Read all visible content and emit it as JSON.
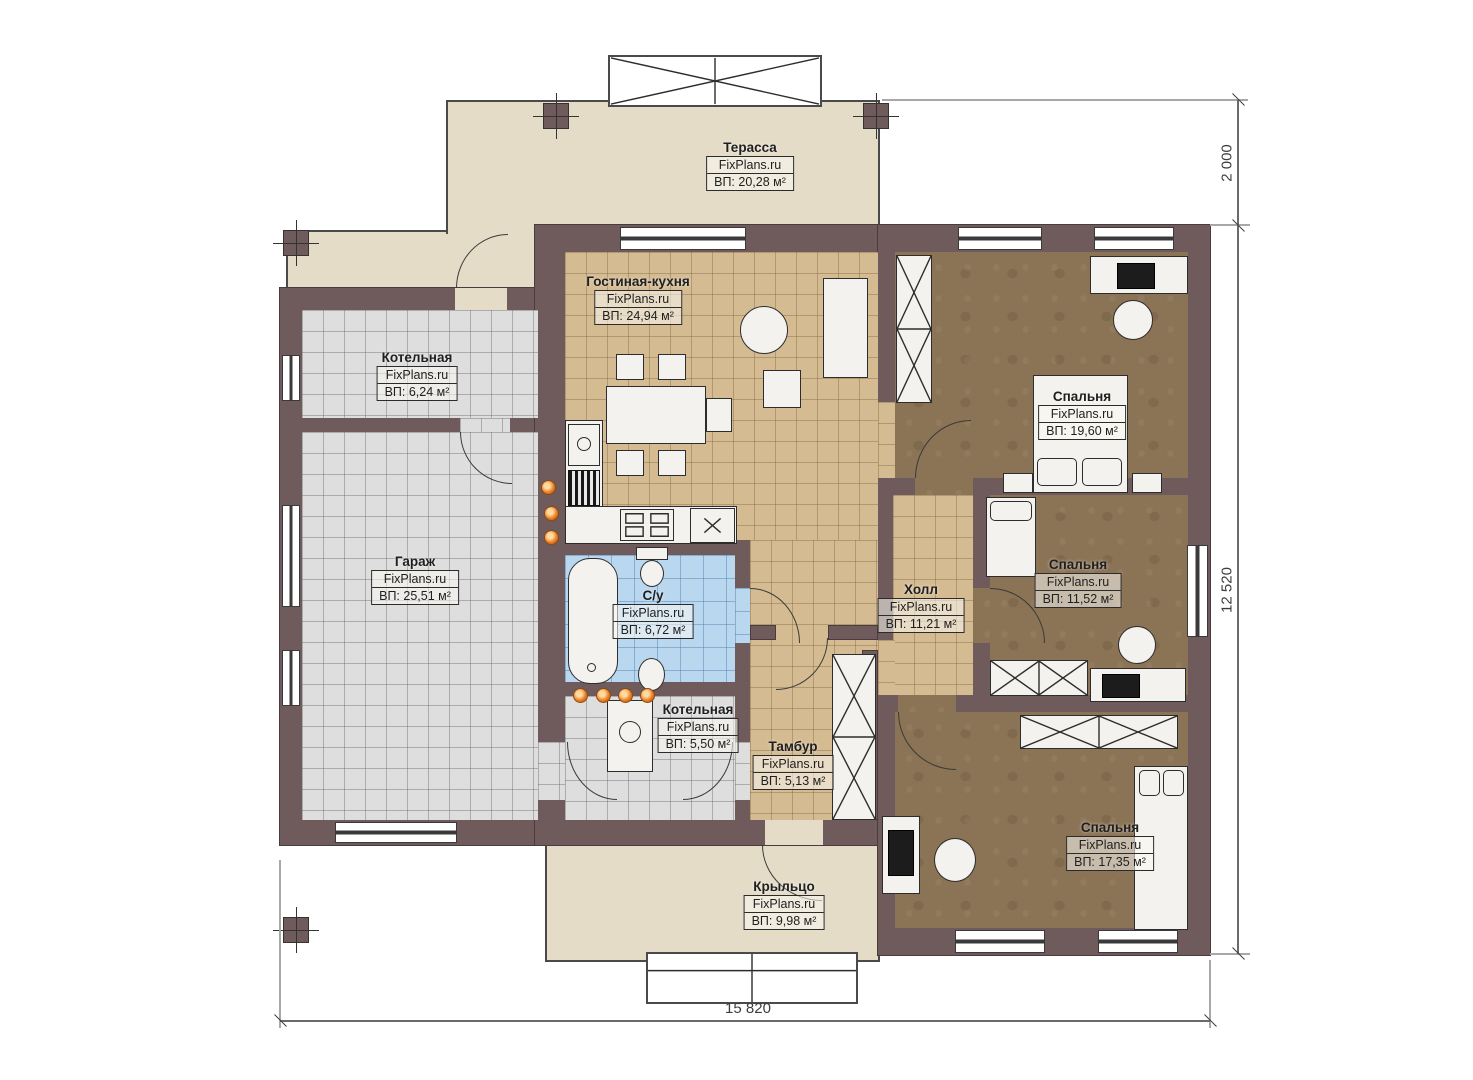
{
  "rooms": [
    {
      "id": "terrace",
      "name": "Терасса",
      "brand": "FixPlans.ru",
      "area": "ВП: 20,28 м²"
    },
    {
      "id": "living-kitchen",
      "name": "Гостиная-кухня",
      "brand": "FixPlans.ru",
      "area": "ВП: 24,94 м²"
    },
    {
      "id": "boiler-room-1",
      "name": "Котельная",
      "brand": "FixPlans.ru",
      "area": "ВП: 6,24 м²"
    },
    {
      "id": "garage",
      "name": "Гараж",
      "brand": "FixPlans.ru",
      "area": "ВП: 25,51 м²"
    },
    {
      "id": "bathroom",
      "name": "С/у",
      "brand": "FixPlans.ru",
      "area": "ВП: 6,72 м²"
    },
    {
      "id": "boiler-room-2",
      "name": "Котельная",
      "brand": "FixPlans.ru",
      "area": "ВП: 5,50 м²"
    },
    {
      "id": "vestibule",
      "name": "Тамбур",
      "brand": "FixPlans.ru",
      "area": "ВП: 5,13 м²"
    },
    {
      "id": "hall",
      "name": "Холл",
      "brand": "FixPlans.ru",
      "area": "ВП: 11,21 м²"
    },
    {
      "id": "bedroom-1",
      "name": "Спальня",
      "brand": "FixPlans.ru",
      "area": "ВП: 19,60 м²"
    },
    {
      "id": "bedroom-2",
      "name": "Спальня",
      "brand": "FixPlans.ru",
      "area": "ВП: 11,52 м²"
    },
    {
      "id": "bedroom-3",
      "name": "Спальня",
      "brand": "FixPlans.ru",
      "area": "ВП: 17,35 м²"
    },
    {
      "id": "porch",
      "name": "Крыльцо",
      "brand": "FixPlans.ru",
      "area": "ВП: 9,98 м²"
    }
  ],
  "dimensions": {
    "terrace_depth": "2 000",
    "side_total": "12 520",
    "bottom_total": "15 820"
  },
  "colors": {
    "wall": "#6f5b5c",
    "floor_tan": "#d4bb92",
    "floor_gray": "#dedede",
    "floor_blue": "#b9d7ef",
    "floor_brown": "#8b7355",
    "floor_beige": "#e5dcc8",
    "valve_orange": "#e8791d"
  }
}
